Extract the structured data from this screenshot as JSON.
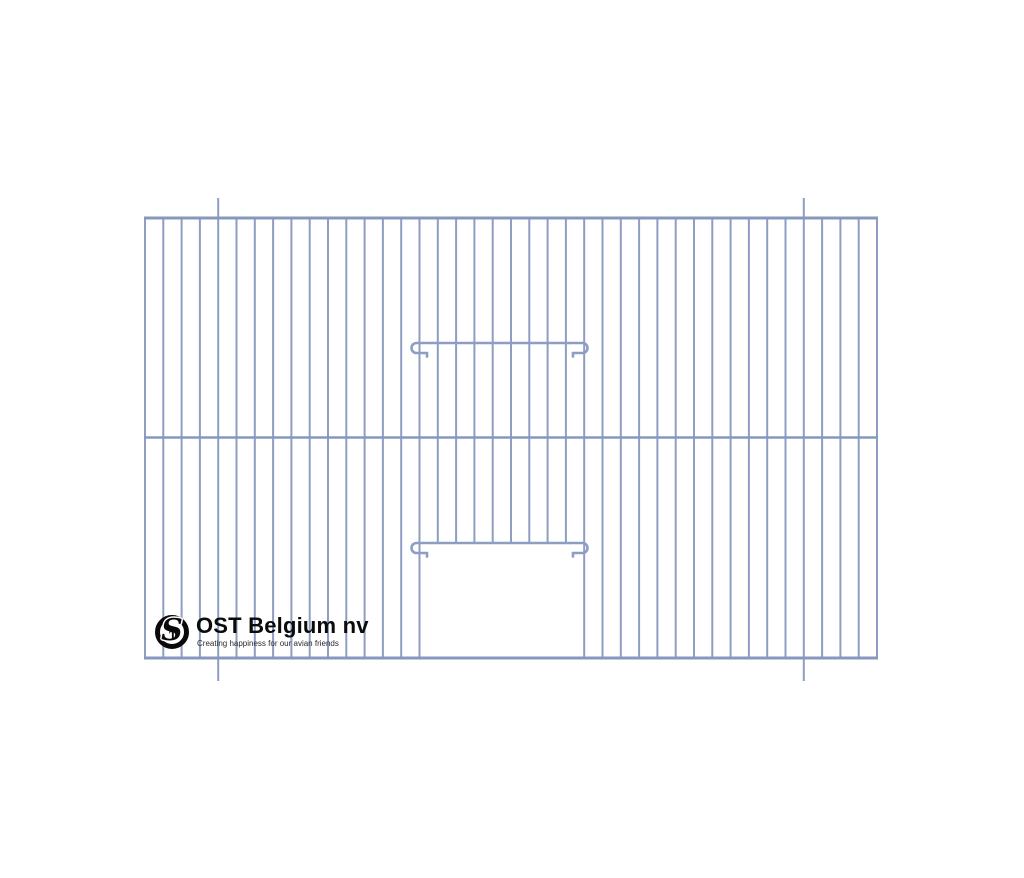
{
  "logo": {
    "title": "OST Belgium nv",
    "tagline": "Creating happiness for our avian friends",
    "monogram_large": "S",
    "monogram_small": "T"
  },
  "drawing": {
    "description": "cage-front-panel-technical-drawing",
    "canvas": {
      "width": 1024,
      "height": 878,
      "background": "#ffffff"
    },
    "colors": {
      "wire": "#8E9DC3",
      "rail": "#8698BE",
      "latch": "#8E9DC3"
    },
    "panel": {
      "left": 145,
      "top": 218,
      "right": 877,
      "bottom": 658
    },
    "mid_rail_y": 437.5,
    "wires": {
      "count": 41,
      "spacing": 18.3,
      "stroke_width": 2,
      "extended_indices": [
        4,
        36
      ],
      "extend_above": 20,
      "extend_below": 23
    },
    "rails": {
      "stroke_width": 3,
      "mid_stroke_width": 2.6
    },
    "door": {
      "removed_wire_start_index": 16,
      "removed_wire_end_index": 23,
      "opening_top_y": 543,
      "left_frame_wire_index": 15,
      "right_frame_wire_index": 24
    },
    "latches": [
      {
        "y": 343,
        "arc_left_x": 416.5,
        "arc_right_x": 582.5,
        "tip_left_x": 427,
        "tip_right_x": 573,
        "drop": 10,
        "radius": 5,
        "tip_stub": 3.5,
        "stroke_width": 2.6
      },
      {
        "y": 543,
        "arc_left_x": 416.5,
        "arc_right_x": 582.5,
        "tip_left_x": 427,
        "tip_right_x": 573,
        "drop": 10,
        "radius": 5,
        "tip_stub": 3.5,
        "stroke_width": 2.6
      }
    ]
  }
}
